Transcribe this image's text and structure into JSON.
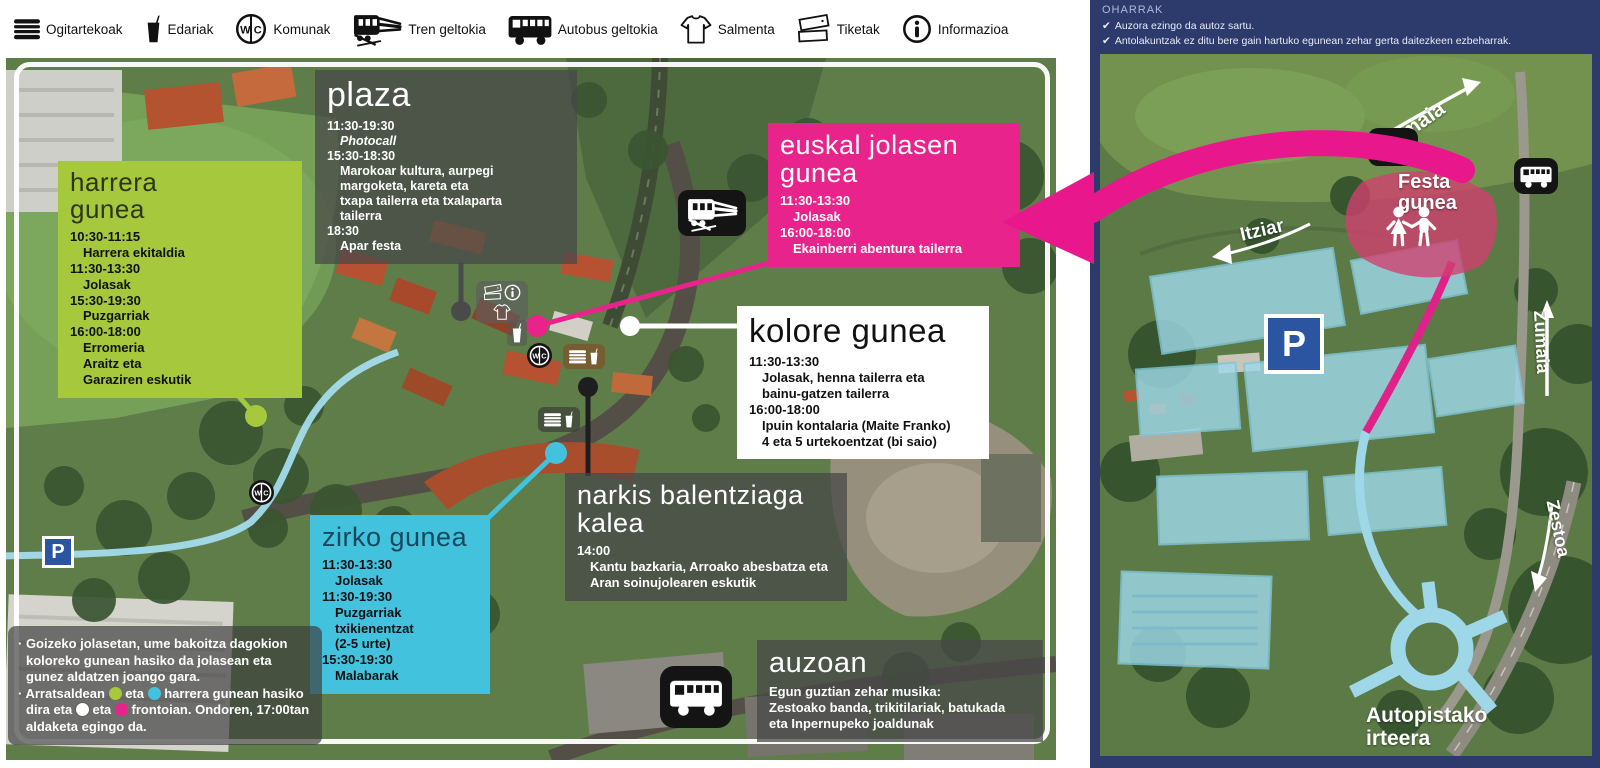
{
  "legend": {
    "items": [
      {
        "icon": "sandwich-icon",
        "label": "Ogitartekoak"
      },
      {
        "icon": "drink-icon",
        "label": "Edariak"
      },
      {
        "icon": "wc-icon",
        "label": "Komunak"
      },
      {
        "icon": "train-icon",
        "label": "Tren geltokia"
      },
      {
        "icon": "bus-icon",
        "label": "Autobus geltokia"
      },
      {
        "icon": "tshirt-icon",
        "label": "Salmenta"
      },
      {
        "icon": "tickets-icon",
        "label": "Tiketak"
      },
      {
        "icon": "info-icon",
        "label": "Informazioa"
      }
    ]
  },
  "zones": {
    "harrera": {
      "title": "harrera gunea",
      "color": "#a6c83d",
      "lines": [
        {
          "type": "time",
          "text": "10:30-11:15"
        },
        {
          "type": "act",
          "text": "Harrera ekitaldia"
        },
        {
          "type": "time",
          "text": "11:30-13:30"
        },
        {
          "type": "act",
          "text": "Jolasak"
        },
        {
          "type": "time",
          "text": "15:30-19:30"
        },
        {
          "type": "act",
          "text": "Puzgarriak"
        },
        {
          "type": "time",
          "text": "16:00-18:00"
        },
        {
          "type": "act",
          "text": "Erromeria"
        },
        {
          "type": "act",
          "text": "Araitz eta"
        },
        {
          "type": "act",
          "text": "Garaziren eskutik"
        }
      ]
    },
    "plaza": {
      "title": "plaza",
      "lines": [
        {
          "type": "time",
          "text": "11:30-19:30"
        },
        {
          "type": "act-italic",
          "text": "Photocall"
        },
        {
          "type": "time",
          "text": "15:30-18:30"
        },
        {
          "type": "act",
          "text": "Marokoar kultura, aurpegi"
        },
        {
          "type": "act",
          "text": "margoketa, kareta eta"
        },
        {
          "type": "act",
          "text": "txapa tailerra eta txalaparta"
        },
        {
          "type": "act",
          "text": "tailerra"
        },
        {
          "type": "time",
          "text": "18:30"
        },
        {
          "type": "act",
          "text": "Apar festa"
        }
      ]
    },
    "euskal": {
      "title": "euskal jolasen gunea",
      "color": "#e8248c",
      "lines": [
        {
          "type": "time",
          "text": "11:30-13:30"
        },
        {
          "type": "act",
          "text": "Jolasak"
        },
        {
          "type": "time",
          "text": "16:00-18:00"
        },
        {
          "type": "act",
          "text": "Ekainberri abentura tailerra"
        }
      ]
    },
    "kolore": {
      "title": "kolore gunea",
      "color": "#ffffff",
      "lines": [
        {
          "type": "time",
          "text": "11:30-13:30"
        },
        {
          "type": "act",
          "text": "Jolasak, henna tailerra eta"
        },
        {
          "type": "act",
          "text": "bainu-gatzen tailerra"
        },
        {
          "type": "time",
          "text": "16:00-18:00"
        },
        {
          "type": "act",
          "text": "Ipuin kontalaria (Maite Franko)"
        },
        {
          "type": "act",
          "text": "4 eta 5 urtekoentzat (bi saio)"
        }
      ]
    },
    "zirko": {
      "title": "zirko gunea",
      "color": "#43c2de",
      "lines": [
        {
          "type": "time",
          "text": "11:30-13:30"
        },
        {
          "type": "act",
          "text": "Jolasak"
        },
        {
          "type": "time",
          "text": "11:30-19:30"
        },
        {
          "type": "act",
          "text": "Puzgarriak txikienentzat"
        },
        {
          "type": "act",
          "text": "(2-5 urte)"
        },
        {
          "type": "time",
          "text": "15:30-19:30"
        },
        {
          "type": "act",
          "text": "Malabarak"
        }
      ]
    },
    "narkis": {
      "title": "narkis balentziaga kalea",
      "lines": [
        {
          "type": "time",
          "text": "14:00"
        },
        {
          "type": "act",
          "text": "Kantu bazkaria, Arroako abesbatza eta"
        },
        {
          "type": "act",
          "text": "Aran soinujolearen eskutik"
        }
      ]
    },
    "auzoan": {
      "title": "auzoan",
      "lines": [
        {
          "type": "act0",
          "text": "Egun guztian zehar musika:"
        },
        {
          "type": "act0",
          "text": "Zestoako banda, trikitilariak, batukada"
        },
        {
          "type": "act0",
          "text": "eta Inpernupeko joaldunak"
        }
      ]
    }
  },
  "footnotes": {
    "note1": "· Goizeko jolasetan, ume bakoitza dagokion koloreko gunean hasiko da jolasean eta gunez aldatzen joango gara.",
    "note2": {
      "s1": "· Arratsaldean",
      "s2": "eta",
      "s3": "harrera gunean hasiko dira eta",
      "s4": "eta",
      "s5": "frontoian. Ondoren, 17:00tan aldaketa egingo da."
    },
    "dot_colors": {
      "green": "#a6c83d",
      "cyan": "#43c2de",
      "white": "#ffffff",
      "pink": "#e8248c"
    }
  },
  "oharrak": {
    "title": "OHARRAK",
    "check": "✔",
    "items": [
      "Auzora ezingo da autoz sartu.",
      "Antolakuntzak ez ditu bere gain hartuko egunean zehar gerta daitezkeen ezbeharrak."
    ]
  },
  "right_map": {
    "labels": {
      "zumaia_top": "Zumaia",
      "itziar": "Itziar",
      "festa_gunea": "Festa gunea",
      "zumaia_right": "Zumaia",
      "zestoa": "Zestoa",
      "highway_exit": "Autopistako irteera"
    }
  },
  "parking_label": "P",
  "colors": {
    "navy_panel": "#2c3a6c",
    "arrow_pink": "#e8188c",
    "overlay_box": "rgba(72,72,72,0.74)"
  }
}
